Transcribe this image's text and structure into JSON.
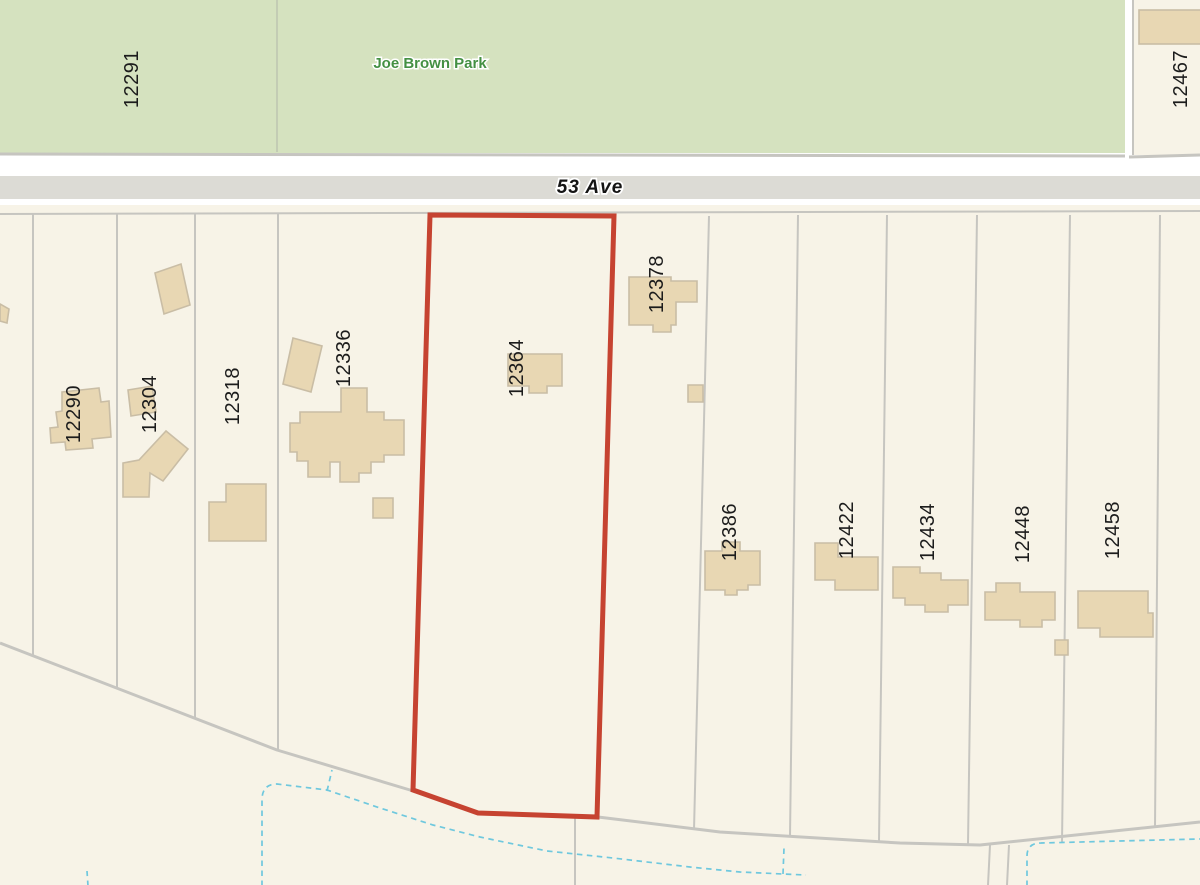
{
  "park": {
    "name": "Joe Brown Park"
  },
  "street": {
    "name": "53 Ave"
  },
  "subject_parcel": {
    "label": "12364",
    "outline_color": "#c64331"
  },
  "parcels": [
    {
      "label": "12291",
      "area": "park"
    },
    {
      "label": "12467"
    },
    {
      "label": "12290"
    },
    {
      "label": "12304"
    },
    {
      "label": "12318"
    },
    {
      "label": "12336"
    },
    {
      "label": "12364",
      "highlighted": true
    },
    {
      "label": "12378"
    },
    {
      "label": "12386"
    },
    {
      "label": "12422"
    },
    {
      "label": "12434"
    },
    {
      "label": "12448"
    },
    {
      "label": "12458"
    }
  ],
  "colors": {
    "park_green": "#d5e2bf",
    "parcel_cream": "#f7f3e7",
    "road_gray": "#dcdbd5",
    "boundary_gray": "#c6c5c0",
    "building_fill": "#e8d7b3",
    "building_border": "#c9bda5",
    "highlight_red": "#c64331",
    "water_dash_blue": "#6fc8de",
    "label_black": "#1c1c1c",
    "park_text_green": "#449043"
  }
}
